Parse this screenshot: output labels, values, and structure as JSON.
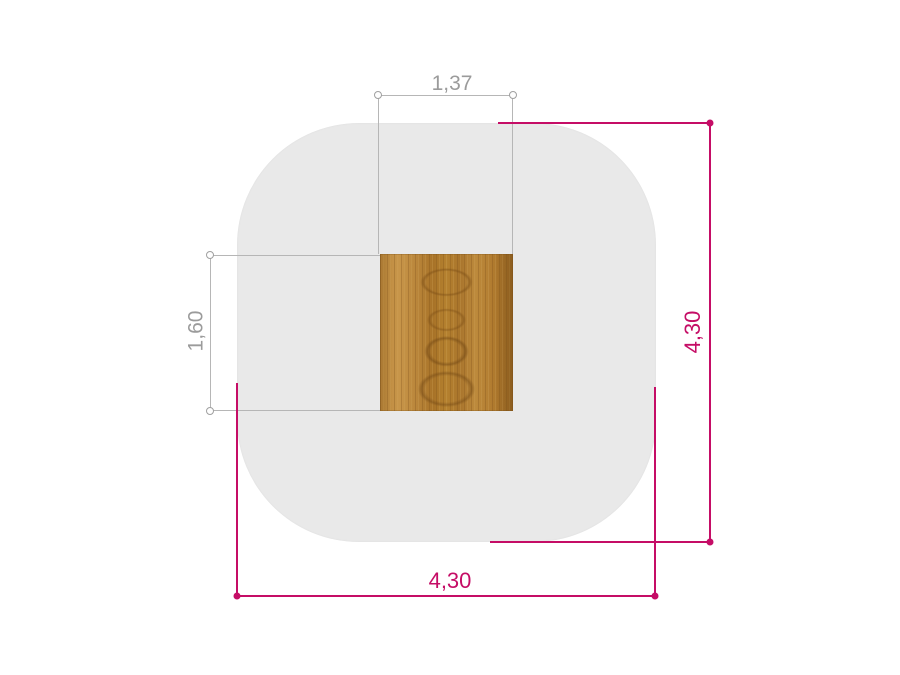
{
  "drawing": {
    "type": "dimensioned-plan-view",
    "background": "#ffffff",
    "shapes": {
      "carpet": {
        "kind": "rounded-square",
        "fill": "#e9e9e9",
        "width_label": "4,30",
        "height_label": "4,30",
        "width_value": 4.3,
        "height_value": 4.3
      },
      "table_top": {
        "kind": "rectangle",
        "material": "wood",
        "colors": {
          "base": "#b5812f",
          "light": "#c8964a",
          "dark": "#8a5c20"
        },
        "width_label": "1,37",
        "height_label": "1,60",
        "width_value": 1.37,
        "height_value": 1.6
      }
    },
    "dimensions": {
      "top": {
        "label": "1,37",
        "value": 1.37,
        "orientation": "horizontal",
        "color": "#9b9b9b",
        "marker": "open-circle",
        "measures": "table-top-width"
      },
      "left": {
        "label": "1,60",
        "value": 1.6,
        "orientation": "vertical",
        "color": "#9b9b9b",
        "marker": "open-circle",
        "measures": "table-top-depth"
      },
      "right": {
        "label": "4,30",
        "value": 4.3,
        "orientation": "vertical",
        "color": "#c50d66",
        "marker": "filled-dot",
        "measures": "carpet-height"
      },
      "bottom": {
        "label": "4,30",
        "value": 4.3,
        "orientation": "horizontal",
        "color": "#c50d66",
        "marker": "filled-dot",
        "measures": "carpet-width"
      }
    }
  }
}
